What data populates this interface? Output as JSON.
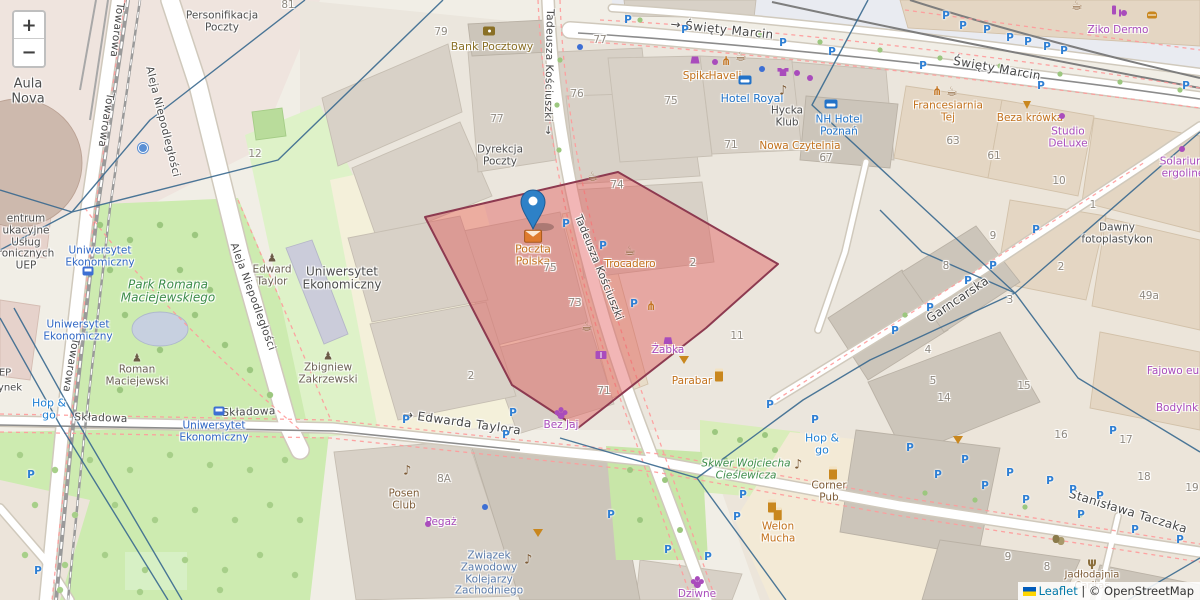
{
  "controls": {
    "zoom_in": "+",
    "zoom_out": "−"
  },
  "attribution": {
    "leaflet": "Leaflet",
    "separator": " | ",
    "osm": "© OpenStreetMap"
  },
  "marker": {
    "title": "Poczta Polska"
  },
  "parking_label": "P",
  "palette": {
    "street": "#474747",
    "place": "#4d4d4d",
    "num": "#8f8980",
    "orange": "#c2711c",
    "purple": "#a94cbc",
    "hblue": "#1f72c8",
    "transit": "#2f66c4",
    "hopgo": "#1f7fd4",
    "brown": "#7d5b36",
    "green": "#3d8d4a",
    "mon": "#6b6154",
    "zw": "#5b7cab",
    "bank": "#8a7026",
    "marker": "#2e81c7",
    "marker_stroke": "#1f5c94",
    "polygon_fill": "#e05252",
    "polygon_stroke": "#8d3a50",
    "network_line": "#39698f",
    "parking": "#2e7fd4"
  },
  "labels": [
    {
      "t": "Towarowa",
      "x": 116,
      "y": 30,
      "c": "street",
      "r": 97
    },
    {
      "t": "Towarowa",
      "x": 105,
      "y": 120,
      "c": "street",
      "r": 99
    },
    {
      "t": "Towarowa",
      "x": 70,
      "y": 365,
      "c": "street",
      "r": 100
    },
    {
      "t": "Aleja Niepodległości",
      "x": 162,
      "y": 122,
      "c": "street",
      "r": 76
    },
    {
      "t": "Aleja Niepodległości",
      "x": 252,
      "y": 297,
      "c": "street",
      "r": 70
    },
    {
      "t": "→ Święty Marcin",
      "x": 722,
      "y": 30,
      "c": "street",
      "s": 12,
      "r": 6
    },
    {
      "t": "Święty Marcin",
      "x": 997,
      "y": 69,
      "c": "street",
      "s": 12,
      "r": 10
    },
    {
      "t": "Tadeusza Kościuszki →",
      "x": 548,
      "y": 72,
      "c": "street",
      "r": 91
    },
    {
      "t": "Tadeusza Kościuszki",
      "x": 598,
      "y": 268,
      "c": "street",
      "r": 68
    },
    {
      "t": "Składowa",
      "x": 101,
      "y": 419,
      "c": "street",
      "r": 2
    },
    {
      "t": "Składowa",
      "x": 249,
      "y": 413,
      "c": "street",
      "r": -2
    },
    {
      "t": "→ Edwarda Taylora",
      "x": 462,
      "y": 423,
      "c": "street",
      "s": 12,
      "r": 8
    },
    {
      "t": "Stanisława Taczaka",
      "x": 1128,
      "y": 512,
      "c": "street",
      "s": 12,
      "r": 17
    },
    {
      "t": "Garncarska",
      "x": 958,
      "y": 300,
      "c": "street",
      "s": 12,
      "r": -34
    },
    {
      "t": "Aula\nNova",
      "x": 28,
      "y": 92,
      "c": "place",
      "s": 13
    },
    {
      "t": "Personifikacja\nPoczty",
      "x": 222,
      "y": 22,
      "c": "place"
    },
    {
      "t": "Dyrekcja\nPoczty",
      "x": 500,
      "y": 156,
      "c": "place"
    },
    {
      "t": "Uniwersytet\nEkonomiczny",
      "x": 342,
      "y": 279,
      "c": "place",
      "s": 12
    },
    {
      "t": "Dawny\nfotoplastykon",
      "x": 1117,
      "y": 234,
      "c": "place"
    },
    {
      "t": "Hycka\nKlub",
      "x": 787,
      "y": 117,
      "c": "place"
    },
    {
      "t": "entrum\nukacyjne\nUsług\nronicznych\nUEP",
      "x": 26,
      "y": 243,
      "c": "place"
    },
    {
      "t": "EP",
      "x": 5,
      "y": 373,
      "c": "place",
      "s": 10
    },
    {
      "t": "ynek",
      "x": 10,
      "y": 388,
      "c": "place",
      "s": 10
    },
    {
      "t": "Edward\nTaylor",
      "x": 272,
      "y": 270,
      "c": "mon",
      "i": "monument"
    },
    {
      "t": "Zbigniew\nZakrzewski",
      "x": 328,
      "y": 368,
      "c": "mon",
      "i": "monument"
    },
    {
      "t": "Roman\nMaciejewski",
      "x": 137,
      "y": 370,
      "c": "mon",
      "i": "monument"
    },
    {
      "t": "Park Romana\nMaciejewskiego",
      "x": 168,
      "y": 292,
      "c": "green",
      "s": 12
    },
    {
      "t": "Skwer Wojciecha\nCieślewicza",
      "x": 746,
      "y": 470,
      "c": "green"
    },
    {
      "t": "Związek\nZawodowy\nKolejarzy\nZachodniego",
      "x": 489,
      "y": 574,
      "c": "zw"
    },
    {
      "t": "Jadłodajnia\nCaritas",
      "x": 1092,
      "y": 574,
      "c": "brown",
      "s": 10,
      "i": "charity"
    },
    {
      "t": "Uniwersytet\nEkonomiczny",
      "x": 100,
      "y": 257,
      "c": "transit"
    },
    {
      "t": "Uniwersytet\nEkonomiczny",
      "x": 78,
      "y": 331,
      "c": "transit"
    },
    {
      "t": "Uniwersytet\nEkonomiczny",
      "x": 214,
      "y": 432,
      "c": "transit"
    },
    {
      "t": "Hop &\ngo",
      "x": 49,
      "y": 410,
      "c": "hopgo",
      "s": 11
    },
    {
      "t": "Hop &\ngo",
      "x": 822,
      "y": 445,
      "c": "hopgo",
      "s": 11
    },
    {
      "t": "Poczta\nPolska",
      "x": 533,
      "y": 249,
      "c": "orange",
      "s": 11,
      "i": "envelope"
    },
    {
      "t": "Trocadero",
      "x": 630,
      "y": 258,
      "c": "orange",
      "i": "cafe"
    },
    {
      "t": "Parabar",
      "x": 692,
      "y": 382,
      "c": "orange"
    },
    {
      "t": "Nowa Czytelnia",
      "x": 800,
      "y": 147,
      "c": "orange"
    },
    {
      "t": "Spika",
      "x": 697,
      "y": 77,
      "c": "orange"
    },
    {
      "t": "Haveli",
      "x": 725,
      "y": 77,
      "c": "orange"
    },
    {
      "t": "Beza krówka",
      "x": 1030,
      "y": 119,
      "c": "orange"
    },
    {
      "t": "Welon\nMucha",
      "x": 778,
      "y": 526,
      "c": "orange",
      "i": "beer"
    },
    {
      "t": "Francesiarnia\nTej",
      "x": 948,
      "y": 112,
      "c": "orange"
    },
    {
      "t": "Żabka",
      "x": 668,
      "y": 347,
      "c": "purple",
      "i": "shop"
    },
    {
      "t": "Pegaż",
      "x": 441,
      "y": 523,
      "c": "purple"
    },
    {
      "t": "Bez Jaj",
      "x": 561,
      "y": 422,
      "c": "purple",
      "i": "grapes"
    },
    {
      "t": "Dziwne",
      "x": 697,
      "y": 591,
      "c": "purple",
      "i": "grapes"
    },
    {
      "t": "Ziko Dermo",
      "x": 1118,
      "y": 31,
      "c": "purple"
    },
    {
      "t": "Studio\nDeLuxe",
      "x": 1068,
      "y": 138,
      "c": "purple"
    },
    {
      "t": "Solarium\nergoline",
      "x": 1183,
      "y": 168,
      "c": "purple"
    },
    {
      "t": "Fajowo eu",
      "x": 1173,
      "y": 372,
      "c": "purple"
    },
    {
      "t": "BodyInk",
      "x": 1177,
      "y": 409,
      "c": "purple"
    },
    {
      "t": "Hotel Royal",
      "x": 752,
      "y": 99,
      "c": "hblue",
      "s": 11
    },
    {
      "t": "NH Hotel\nPoznań",
      "x": 839,
      "y": 126,
      "c": "hblue"
    },
    {
      "t": "Bank Pocztowy",
      "x": 492,
      "y": 47,
      "c": "bank",
      "s": 11
    },
    {
      "t": "Corner\nPub",
      "x": 829,
      "y": 492,
      "c": "brown"
    },
    {
      "t": "Posen\nClub",
      "x": 404,
      "y": 500,
      "c": "brown"
    },
    {
      "t": "81",
      "x": 288,
      "y": 6,
      "c": "num"
    },
    {
      "t": "79",
      "x": 441,
      "y": 33,
      "c": "num"
    },
    {
      "t": "77",
      "x": 497,
      "y": 120,
      "c": "num"
    },
    {
      "t": "77",
      "x": 600,
      "y": 41,
      "c": "num"
    },
    {
      "t": "76",
      "x": 577,
      "y": 95,
      "c": "num"
    },
    {
      "t": "75",
      "x": 671,
      "y": 102,
      "c": "num"
    },
    {
      "t": "71",
      "x": 731,
      "y": 146,
      "c": "num"
    },
    {
      "t": "67",
      "x": 826,
      "y": 159,
      "c": "num"
    },
    {
      "t": "74",
      "x": 617,
      "y": 186,
      "c": "num"
    },
    {
      "t": "63",
      "x": 953,
      "y": 142,
      "c": "num"
    },
    {
      "t": "61",
      "x": 994,
      "y": 157,
      "c": "num"
    },
    {
      "t": "10",
      "x": 1059,
      "y": 182,
      "c": "num"
    },
    {
      "t": "1",
      "x": 1093,
      "y": 206,
      "c": "num"
    },
    {
      "t": "2",
      "x": 1061,
      "y": 268,
      "c": "num"
    },
    {
      "t": "9",
      "x": 993,
      "y": 237,
      "c": "num"
    },
    {
      "t": "8",
      "x": 946,
      "y": 267,
      "c": "num"
    },
    {
      "t": "3",
      "x": 1010,
      "y": 301,
      "c": "num"
    },
    {
      "t": "4",
      "x": 928,
      "y": 351,
      "c": "num"
    },
    {
      "t": "5",
      "x": 933,
      "y": 382,
      "c": "num"
    },
    {
      "t": "14",
      "x": 944,
      "y": 399,
      "c": "num"
    },
    {
      "t": "15",
      "x": 1024,
      "y": 387,
      "c": "num"
    },
    {
      "t": "49a",
      "x": 1149,
      "y": 297,
      "c": "num"
    },
    {
      "t": "75",
      "x": 550,
      "y": 269,
      "c": "num"
    },
    {
      "t": "73",
      "x": 575,
      "y": 304,
      "c": "num"
    },
    {
      "t": "71",
      "x": 604,
      "y": 392,
      "c": "num"
    },
    {
      "t": "2",
      "x": 693,
      "y": 264,
      "c": "num"
    },
    {
      "t": "2",
      "x": 471,
      "y": 377,
      "c": "num"
    },
    {
      "t": "11",
      "x": 737,
      "y": 337,
      "c": "num"
    },
    {
      "t": "12",
      "x": 255,
      "y": 155,
      "c": "num"
    },
    {
      "t": "16",
      "x": 1061,
      "y": 436,
      "c": "num"
    },
    {
      "t": "17",
      "x": 1126,
      "y": 441,
      "c": "num"
    },
    {
      "t": "18",
      "x": 1144,
      "y": 478,
      "c": "num"
    },
    {
      "t": "19",
      "x": 1192,
      "y": 489,
      "c": "num"
    },
    {
      "t": "9",
      "x": 1008,
      "y": 558,
      "c": "num"
    },
    {
      "t": "8",
      "x": 1047,
      "y": 568,
      "c": "num"
    },
    {
      "t": "8A",
      "x": 444,
      "y": 480,
      "c": "num"
    }
  ],
  "icons": [
    {
      "i": "cafe",
      "x": 742,
      "y": 57
    },
    {
      "i": "cafe",
      "x": 953,
      "y": 92
    },
    {
      "i": "cafe",
      "x": 594,
      "y": 177
    },
    {
      "i": "cafe",
      "x": 588,
      "y": 327
    },
    {
      "i": "cafe",
      "x": 1078,
      "y": 6
    },
    {
      "i": "restaurant",
      "x": 727,
      "y": 61
    },
    {
      "i": "restaurant",
      "x": 938,
      "y": 91
    },
    {
      "i": "restaurant",
      "x": 652,
      "y": 306
    },
    {
      "i": "beer",
      "x": 719,
      "y": 375
    },
    {
      "i": "beer",
      "x": 772,
      "y": 506
    },
    {
      "i": "beer",
      "x": 833,
      "y": 473
    },
    {
      "i": "music",
      "x": 785,
      "y": 91
    },
    {
      "i": "music",
      "x": 409,
      "y": 471
    },
    {
      "i": "music",
      "x": 800,
      "y": 465
    },
    {
      "i": "music",
      "x": 530,
      "y": 560
    },
    {
      "i": "hotel",
      "x": 745,
      "y": 80
    },
    {
      "i": "hotel",
      "x": 831,
      "y": 104
    },
    {
      "i": "bank",
      "x": 489,
      "y": 31
    },
    {
      "i": "shop",
      "x": 695,
      "y": 60
    },
    {
      "i": "tshirt",
      "x": 783,
      "y": 72
    },
    {
      "i": "book",
      "x": 601,
      "y": 355
    },
    {
      "i": "masks",
      "x": 1056,
      "y": 539
    },
    {
      "i": "cocktail",
      "x": 684,
      "y": 360
    },
    {
      "i": "cocktail",
      "x": 958,
      "y": 440
    },
    {
      "i": "cocktail",
      "x": 538,
      "y": 533
    },
    {
      "i": "icecream",
      "x": 1027,
      "y": 104
    },
    {
      "i": "burger",
      "x": 1152,
      "y": 15
    },
    {
      "i": "wine",
      "x": 1114,
      "y": 10
    },
    {
      "i": "dot-purple",
      "x": 715,
      "y": 62
    },
    {
      "i": "dot-purple",
      "x": 797,
      "y": 73
    },
    {
      "i": "dot-purple",
      "x": 810,
      "y": 78
    },
    {
      "i": "dot-purple",
      "x": 1124,
      "y": 13
    },
    {
      "i": "dot-purple",
      "x": 428,
      "y": 524
    },
    {
      "i": "dot-purple",
      "x": 1062,
      "y": 116
    },
    {
      "i": "dot-purple",
      "x": 1182,
      "y": 149
    },
    {
      "i": "dot-blue",
      "x": 580,
      "y": 47
    },
    {
      "i": "dot-blue",
      "x": 762,
      "y": 69
    },
    {
      "i": "dot-blue",
      "x": 485,
      "y": 507
    },
    {
      "i": "fountain",
      "x": 143,
      "y": 148
    },
    {
      "i": "tram",
      "x": 88,
      "y": 271
    },
    {
      "i": "tram",
      "x": 219,
      "y": 411
    }
  ],
  "parkings": [
    [
      628,
      20
    ],
    [
      685,
      30
    ],
    [
      783,
      43
    ],
    [
      832,
      52
    ],
    [
      946,
      16
    ],
    [
      963,
      26
    ],
    [
      987,
      30
    ],
    [
      1010,
      38
    ],
    [
      1028,
      42
    ],
    [
      1047,
      47
    ],
    [
      1064,
      51
    ],
    [
      923,
      66
    ],
    [
      1041,
      86
    ],
    [
      1186,
      86
    ],
    [
      566,
      224
    ],
    [
      603,
      246
    ],
    [
      634,
      304
    ],
    [
      1036,
      230
    ],
    [
      993,
      266
    ],
    [
      968,
      281
    ],
    [
      930,
      308
    ],
    [
      895,
      331
    ],
    [
      910,
      448
    ],
    [
      965,
      460
    ],
    [
      938,
      475
    ],
    [
      1010,
      473
    ],
    [
      1050,
      481
    ],
    [
      1073,
      490
    ],
    [
      985,
      486
    ],
    [
      1026,
      500
    ],
    [
      1081,
      515
    ],
    [
      1100,
      496
    ],
    [
      1135,
      530
    ],
    [
      1180,
      540
    ],
    [
      1113,
      431
    ],
    [
      611,
      515
    ],
    [
      668,
      550
    ],
    [
      708,
      557
    ],
    [
      737,
      517
    ],
    [
      743,
      495
    ],
    [
      770,
      405
    ],
    [
      815,
      420
    ],
    [
      406,
      420
    ],
    [
      513,
      413
    ],
    [
      506,
      435
    ],
    [
      31,
      475
    ],
    [
      38,
      571
    ]
  ]
}
